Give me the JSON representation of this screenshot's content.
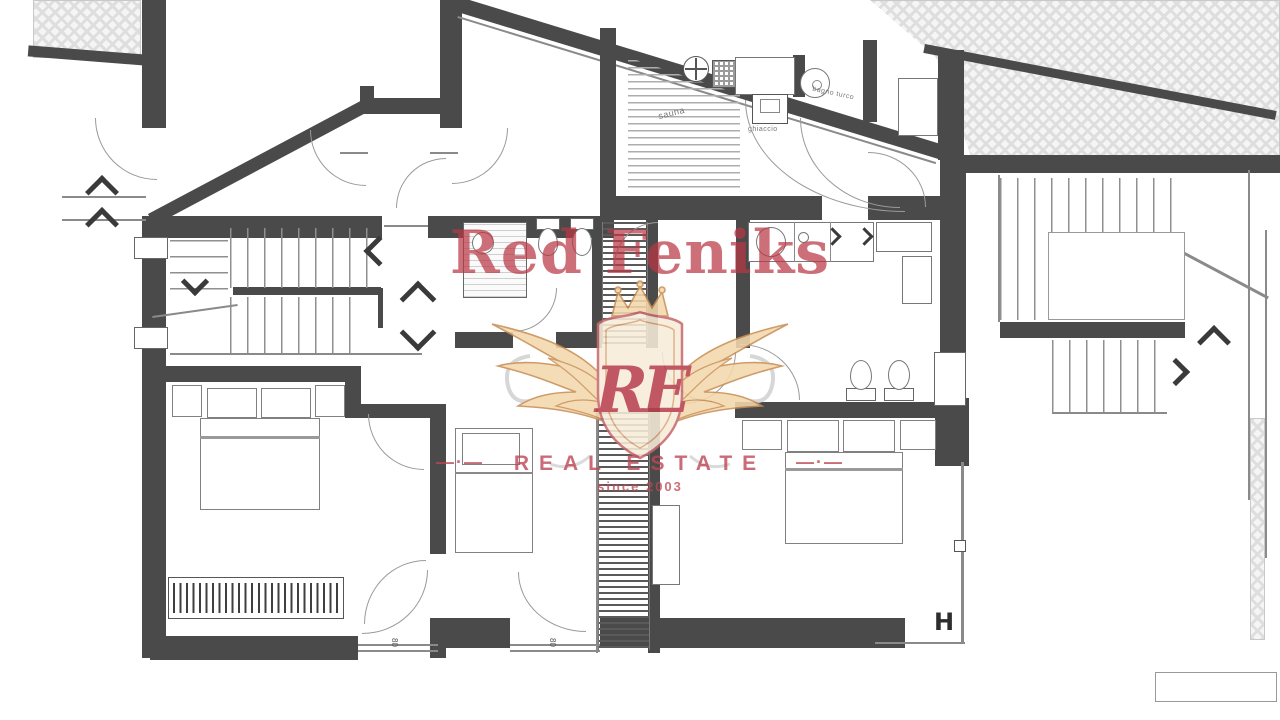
{
  "watermark": {
    "title": "Red Feniks",
    "monogram": "RE",
    "tagline": "REAL ESTATE",
    "dashes": "—·—",
    "since": "since 2003",
    "accent_color": "#ba3844",
    "wing_color": "#f3d8ad"
  },
  "plan": {
    "labels": {
      "sauna": "sauna",
      "ice_fountain": "ghiaccio",
      "steam_bath": "bagno turco",
      "beam_mark": "H",
      "dim_opening_left": "80",
      "dim_opening_right": "80"
    },
    "colors": {
      "wall": "#4a4a4a",
      "thin_line": "#8a8a8a",
      "hatch_fill": "#f5f5f5"
    }
  }
}
